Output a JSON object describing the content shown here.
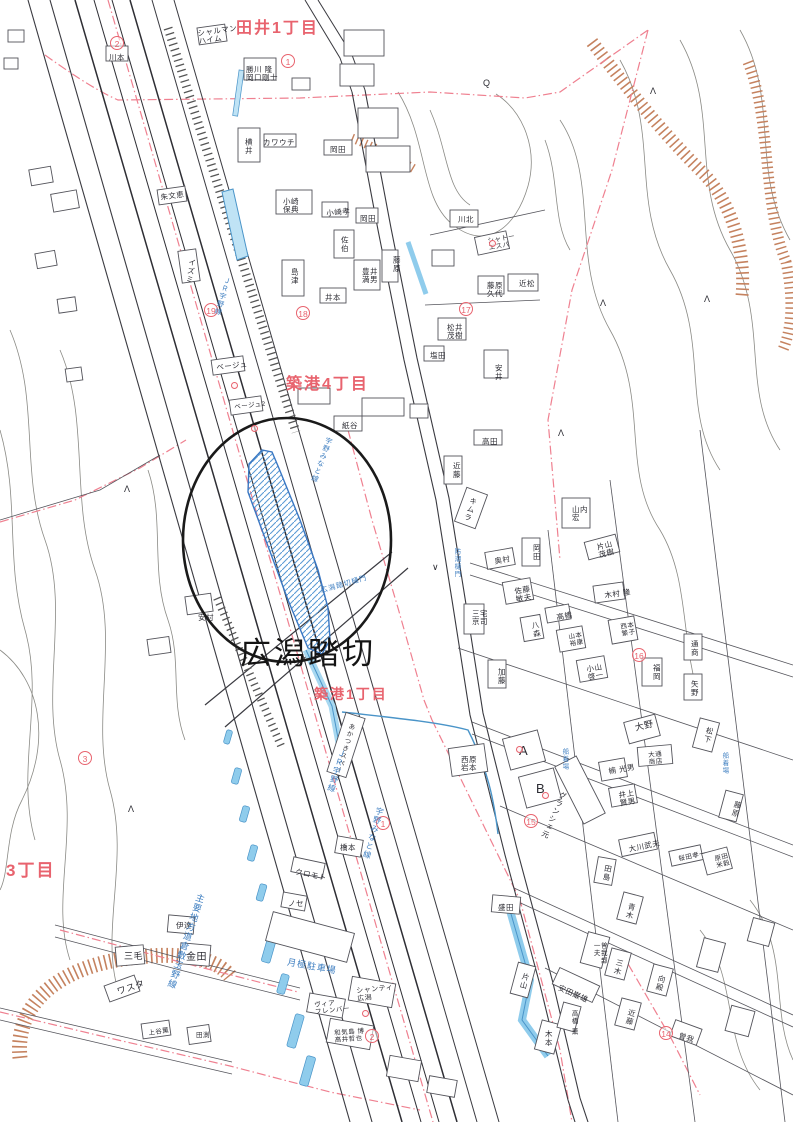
{
  "map": {
    "main_label": {
      "text": "広潟踏切",
      "x": 240,
      "y": 628,
      "size": 31
    },
    "district_labels": [
      {
        "t": "田井1丁目",
        "x": 236,
        "y": 14,
        "s": 16
      },
      {
        "t": "築港4丁目",
        "x": 286,
        "y": 370,
        "s": 16
      },
      {
        "t": "築港1丁目",
        "x": 314,
        "y": 684,
        "s": 14
      },
      {
        "t": "3丁目",
        "x": 6,
        "y": 856,
        "s": 17
      }
    ],
    "circled_numbers": [
      {
        "n": "2",
        "x": 110,
        "y": 36
      },
      {
        "n": "1",
        "x": 281,
        "y": 54
      },
      {
        "n": "19",
        "x": 204,
        "y": 303
      },
      {
        "n": "18",
        "x": 296,
        "y": 306
      },
      {
        "n": "17",
        "x": 459,
        "y": 302
      },
      {
        "n": "3",
        "x": 78,
        "y": 751
      },
      {
        "n": "16",
        "x": 632,
        "y": 648
      },
      {
        "n": "15",
        "x": 524,
        "y": 814
      },
      {
        "n": "1",
        "x": 376,
        "y": 816
      },
      {
        "n": "14",
        "x": 659,
        "y": 1026
      },
      {
        "n": "2",
        "x": 365,
        "y": 1029
      }
    ],
    "building_labels": [
      {
        "t": "シャルマン\nハイム",
        "x": 197,
        "y": 30,
        "r": -8
      },
      {
        "t": "川本",
        "x": 109,
        "y": 54
      },
      {
        "t": "勝川 隆\n岡口剛士",
        "x": 246,
        "y": 66
      },
      {
        "t": "横井",
        "x": 244,
        "y": 138,
        "v": 1
      },
      {
        "t": "カワウチ",
        "x": 263,
        "y": 139
      },
      {
        "t": "岡田",
        "x": 330,
        "y": 146
      },
      {
        "t": "小崎\n保典",
        "x": 283,
        "y": 198
      },
      {
        "t": "小崎孝",
        "x": 326,
        "y": 210,
        "r": -6
      },
      {
        "t": "岡田",
        "x": 360,
        "y": 215
      },
      {
        "t": "佐伯",
        "x": 340,
        "y": 236,
        "v": 1
      },
      {
        "t": "島津",
        "x": 290,
        "y": 268,
        "v": 1
      },
      {
        "t": "豊井\n満男",
        "x": 362,
        "y": 268
      },
      {
        "t": "藤原",
        "x": 392,
        "y": 256,
        "v": 1
      },
      {
        "t": "井本",
        "x": 325,
        "y": 294
      },
      {
        "t": "川北",
        "x": 458,
        "y": 216
      },
      {
        "t": "シャトー\nエスパ",
        "x": 487,
        "y": 238,
        "r": -10,
        "s": 6.5
      },
      {
        "t": "近松",
        "x": 519,
        "y": 280
      },
      {
        "t": "藤原\n久代",
        "x": 487,
        "y": 282
      },
      {
        "t": "松井\n茂樹",
        "x": 447,
        "y": 324
      },
      {
        "t": "塩田",
        "x": 430,
        "y": 352
      },
      {
        "t": "安井",
        "x": 494,
        "y": 364,
        "v": 1
      },
      {
        "t": "朱文恵",
        "x": 160,
        "y": 194,
        "r": -8
      },
      {
        "t": "イズミ",
        "x": 188,
        "y": 258,
        "v": 1,
        "r": 8
      },
      {
        "t": "ベージュ",
        "x": 216,
        "y": 364,
        "r": -6
      },
      {
        "t": "ベージュ2",
        "x": 234,
        "y": 404,
        "r": -6,
        "s": 6.5
      },
      {
        "t": "紙谷",
        "x": 342,
        "y": 422
      },
      {
        "t": "安村",
        "x": 198,
        "y": 614
      },
      {
        "t": "高田",
        "x": 482,
        "y": 438
      },
      {
        "t": "近藤",
        "x": 452,
        "y": 462,
        "v": 1
      },
      {
        "t": "キムラ",
        "x": 470,
        "y": 496,
        "v": 1,
        "r": 18
      },
      {
        "t": "山内\n宏",
        "x": 572,
        "y": 506
      },
      {
        "t": "片山\n茂樹",
        "x": 596,
        "y": 544,
        "r": -14
      },
      {
        "t": "奥村",
        "x": 494,
        "y": 558,
        "r": -10
      },
      {
        "t": "岡田",
        "x": 532,
        "y": 544,
        "v": 1
      },
      {
        "t": "佐藤\n敏夫",
        "x": 514,
        "y": 588,
        "r": -10
      },
      {
        "t": "木村 隆",
        "x": 604,
        "y": 592,
        "r": -8
      },
      {
        "t": "高橋",
        "x": 556,
        "y": 614,
        "r": -10
      },
      {
        "t": "八森",
        "x": 530,
        "y": 622,
        "v": 1,
        "r": -10
      },
      {
        "t": "山本\n裕康",
        "x": 568,
        "y": 634,
        "r": -10,
        "s": 6.5
      },
      {
        "t": "西本\n繁子",
        "x": 620,
        "y": 624,
        "r": -10,
        "s": 6.5
      },
      {
        "t": "三宅\n京司",
        "x": 472,
        "y": 610
      },
      {
        "t": "通商",
        "x": 690,
        "y": 640,
        "v": 1
      },
      {
        "t": "矢野",
        "x": 690,
        "y": 680,
        "v": 1
      },
      {
        "t": "福岡",
        "x": 652,
        "y": 664,
        "v": 1
      },
      {
        "t": "小山\n啓一",
        "x": 586,
        "y": 666,
        "r": -10
      },
      {
        "t": "加藤",
        "x": 497,
        "y": 668,
        "v": 1
      },
      {
        "t": "大野",
        "x": 634,
        "y": 724,
        "r": -14,
        "s": 9
      },
      {
        "t": "大通\n商店",
        "x": 648,
        "y": 752,
        "r": -5,
        "s": 6.5
      },
      {
        "t": "松下",
        "x": 706,
        "y": 726,
        "v": 1,
        "r": 14
      },
      {
        "t": "楠 光男",
        "x": 608,
        "y": 768,
        "r": -10
      },
      {
        "t": "井上\n賢男",
        "x": 618,
        "y": 792,
        "r": -10
      },
      {
        "t": "藤原",
        "x": 734,
        "y": 800,
        "v": 1,
        "r": 14
      },
      {
        "t": "グランシェ元",
        "x": 560,
        "y": 790,
        "v": 1,
        "r": 24
      },
      {
        "t": "A",
        "x": 519,
        "y": 744,
        "s": 13
      },
      {
        "t": "B",
        "x": 536,
        "y": 782,
        "s": 13
      },
      {
        "t": "西原\n岩本",
        "x": 461,
        "y": 756
      },
      {
        "t": "大川武夫",
        "x": 628,
        "y": 846,
        "r": -12
      },
      {
        "t": "桜田孝一",
        "x": 678,
        "y": 856,
        "s": 6.5,
        "r": -12
      },
      {
        "t": "原田\n米穀",
        "x": 714,
        "y": 856,
        "r": -14,
        "s": 6.5
      },
      {
        "t": "田島",
        "x": 604,
        "y": 864,
        "v": 1,
        "r": 10
      },
      {
        "t": "盛田",
        "x": 498,
        "y": 904
      },
      {
        "t": "片山",
        "x": 522,
        "y": 972,
        "v": 1,
        "r": 14
      },
      {
        "t": "安田巌雄",
        "x": 560,
        "y": 984,
        "r": 24
      },
      {
        "t": "高橋 薫",
        "x": 570,
        "y": 1010,
        "v": 1,
        "s": 6.5
      },
      {
        "t": "木本",
        "x": 544,
        "y": 1030,
        "v": 1
      },
      {
        "t": "近藤",
        "x": 628,
        "y": 1008,
        "v": 1,
        "r": 14
      },
      {
        "t": "三木",
        "x": 616,
        "y": 958,
        "v": 1,
        "r": 14
      },
      {
        "t": "向殿",
        "x": 658,
        "y": 974,
        "v": 1,
        "r": 14
      },
      {
        "t": "曽我",
        "x": 680,
        "y": 1032,
        "r": 18
      },
      {
        "t": "青木",
        "x": 628,
        "y": 902,
        "v": 1,
        "r": 14
      },
      {
        "t": "曽我部\n一夫",
        "x": 592,
        "y": 942,
        "v": 1,
        "s": 6.5
      },
      {
        "t": "伊達",
        "x": 176,
        "y": 922
      },
      {
        "t": "三毛",
        "x": 124,
        "y": 952,
        "s": 9
      },
      {
        "t": "金田",
        "x": 186,
        "y": 952,
        "s": 10
      },
      {
        "t": "ワスタ",
        "x": 116,
        "y": 988,
        "r": -18,
        "s": 9
      },
      {
        "t": "上谷薫",
        "x": 148,
        "y": 1030,
        "r": -8,
        "s": 6.5
      },
      {
        "t": "田渕",
        "x": 196,
        "y": 1032,
        "s": 6.5
      },
      {
        "t": "クロモト",
        "x": 296,
        "y": 868,
        "r": 12
      },
      {
        "t": "橋本",
        "x": 340,
        "y": 844
      },
      {
        "t": "ノセ",
        "x": 288,
        "y": 900
      },
      {
        "t": "シャンティ\n広潟",
        "x": 356,
        "y": 988,
        "r": -6,
        "s": 7
      },
      {
        "t": "ヴィア\nフレンバー",
        "x": 314,
        "y": 1002,
        "s": 6.5,
        "r": -6
      },
      {
        "t": "和気島 博\n高井哲也",
        "x": 334,
        "y": 1030,
        "s": 6.5,
        "r": -4
      },
      {
        "t": "あかつきスペース",
        "x": 348,
        "y": 722,
        "v": 1,
        "r": 16,
        "s": 6.5
      }
    ],
    "blue_labels": [
      {
        "t": "ＪＲ宇野線",
        "x": 224,
        "y": 276,
        "v": 1,
        "r": 16,
        "s": 7
      },
      {
        "t": "宇野みなと線",
        "x": 326,
        "y": 436,
        "v": 1,
        "r": 20,
        "s": 7
      },
      {
        "t": "ＪＲ宇野線",
        "x": 338,
        "y": 748,
        "v": 1,
        "r": 16,
        "s": 8
      },
      {
        "t": "宇野みなと線",
        "x": 376,
        "y": 806,
        "v": 1,
        "r": 16,
        "s": 8
      },
      {
        "t": "広潟踏切樋門",
        "x": 320,
        "y": 588,
        "r": -16,
        "s": 7
      },
      {
        "t": "船着場",
        "x": 560,
        "y": 748,
        "v": 1,
        "s": 6.5
      },
      {
        "t": "船着場",
        "x": 720,
        "y": 752,
        "v": 1,
        "s": 6.5
      },
      {
        "t": "月極駐車場",
        "x": 288,
        "y": 958,
        "r": 10,
        "s": 9
      },
      {
        "t": "主要地方道倉敷玉野線",
        "x": 196,
        "y": 892,
        "v": 1,
        "r": 18,
        "s": 9
      },
      {
        "t": "防潮樋門",
        "x": 452,
        "y": 548,
        "v": 1,
        "s": 6.5
      }
    ],
    "red_dots": [
      [
        231,
        382
      ],
      [
        362,
        1010
      ],
      [
        516,
        746
      ],
      [
        542,
        792
      ],
      [
        489,
        240
      ],
      [
        251,
        425
      ]
    ],
    "symbols": {
      "lambda": [
        [
          128,
          804
        ],
        [
          600,
          298
        ],
        [
          650,
          86
        ],
        [
          704,
          294
        ],
        [
          558,
          428
        ],
        [
          124,
          484
        ]
      ],
      "check": [
        [
          432,
          562
        ]
      ],
      "q": [
        483,
        78
      ]
    },
    "palette": {
      "district_red": "#e8636e",
      "boundary_pink": "#ef8090",
      "water_fill": "#bfe3f5",
      "water_stroke": "#4a94c8",
      "blue_text": "#3f7fc1",
      "building_ink": "#53535a",
      "contour_gray": "#8a8a85",
      "slope_brown": "#c5825f",
      "annotation_black": "#1a1a1a"
    }
  }
}
